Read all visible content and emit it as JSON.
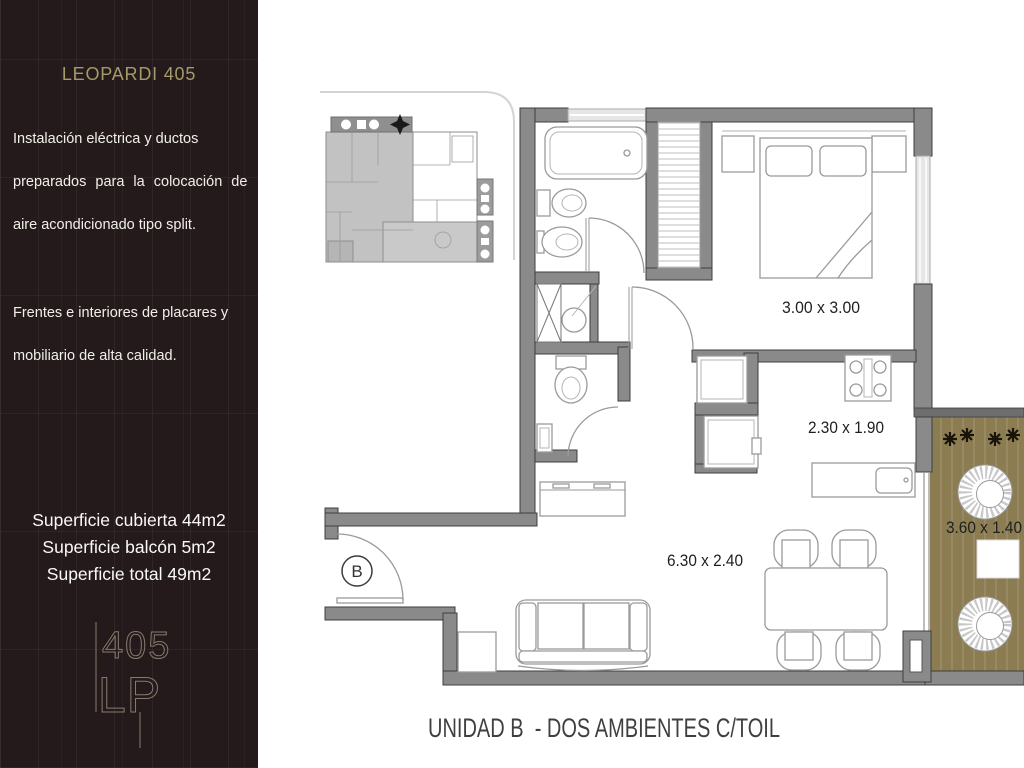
{
  "sidebar": {
    "title": "LEOPARDI 405",
    "paragraph1_lines": [
      "Instalación eléctrica y ductos",
      "preparados para la colocación de",
      "aire acondicionado tipo split."
    ],
    "paragraph2_lines": [
      "Frentes e interiores de placares y",
      "mobiliario de alta calidad."
    ],
    "areas": {
      "covered": "Superficie cubierta 44m2",
      "balcony": "Superficie balcón 5m2",
      "total": "Superficie total 49m2"
    },
    "logo": {
      "number": "405",
      "letters": "LP"
    },
    "colors": {
      "background": "#241a1b",
      "title_gold": "#a69a68",
      "body_text": "#f2efe9",
      "logo_line": "#8a7a6d"
    }
  },
  "floorplan": {
    "unit_label": "B",
    "caption": "UNIDAD B  - DOS AMBIENTES C/TOIL",
    "dimensions": {
      "bedroom": "3.00 x 3.00",
      "kitchen": "2.30 x 1.90",
      "living_dining": "6.30 x 2.40",
      "balcony": "3.60 x 1.40"
    },
    "colors": {
      "wall": "#8a8a8a",
      "wall_outline": "#3e3e3e",
      "furniture_line": "#9a9a9a",
      "window_fill": "#e6e6e6",
      "deck_olive": "#8b7c52",
      "plant_black": "#191308",
      "caption_text": "#3f3f3f"
    }
  }
}
